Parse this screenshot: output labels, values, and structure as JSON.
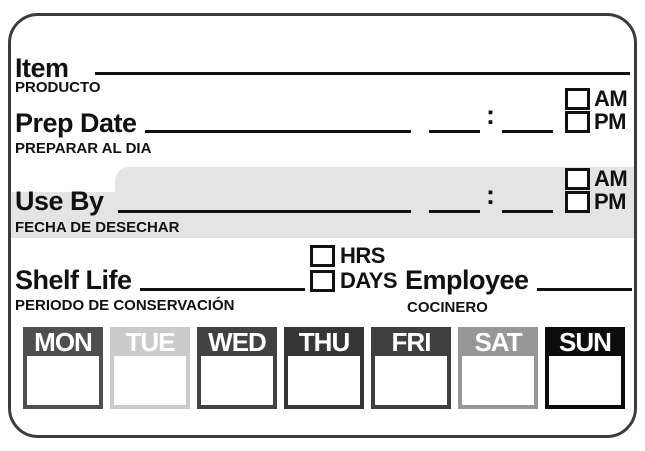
{
  "label": {
    "item": {
      "label": "Item",
      "sublabel": "PRODUCTO"
    },
    "prep_date": {
      "label": "Prep Date",
      "sublabel": "PREPARAR AL DIA",
      "am": "AM",
      "pm": "PM",
      "colon": ":"
    },
    "use_by": {
      "label": "Use By",
      "sublabel": "FECHA DE DESECHAR",
      "am": "AM",
      "pm": "PM",
      "colon": ":"
    },
    "shelf_life": {
      "label": "Shelf Life",
      "sublabel": "PERIODO DE CONSERVACIÓN",
      "hrs": "HRS",
      "days_opt": "DAYS"
    },
    "employee": {
      "label": "Employee",
      "sublabel": "COCINERO"
    },
    "days": [
      {
        "name": "MON",
        "color": "#4f4f4f"
      },
      {
        "name": "TUE",
        "color": "#cbcbcb"
      },
      {
        "name": "WED",
        "color": "#424242"
      },
      {
        "name": "THU",
        "color": "#363636"
      },
      {
        "name": "FRI",
        "color": "#404040"
      },
      {
        "name": "SAT",
        "color": "#979797"
      },
      {
        "name": "SUN",
        "color": "#0c0c0c"
      }
    ],
    "colors": {
      "highlight": "#e4e4e4",
      "border": "#3c3c3c"
    }
  }
}
